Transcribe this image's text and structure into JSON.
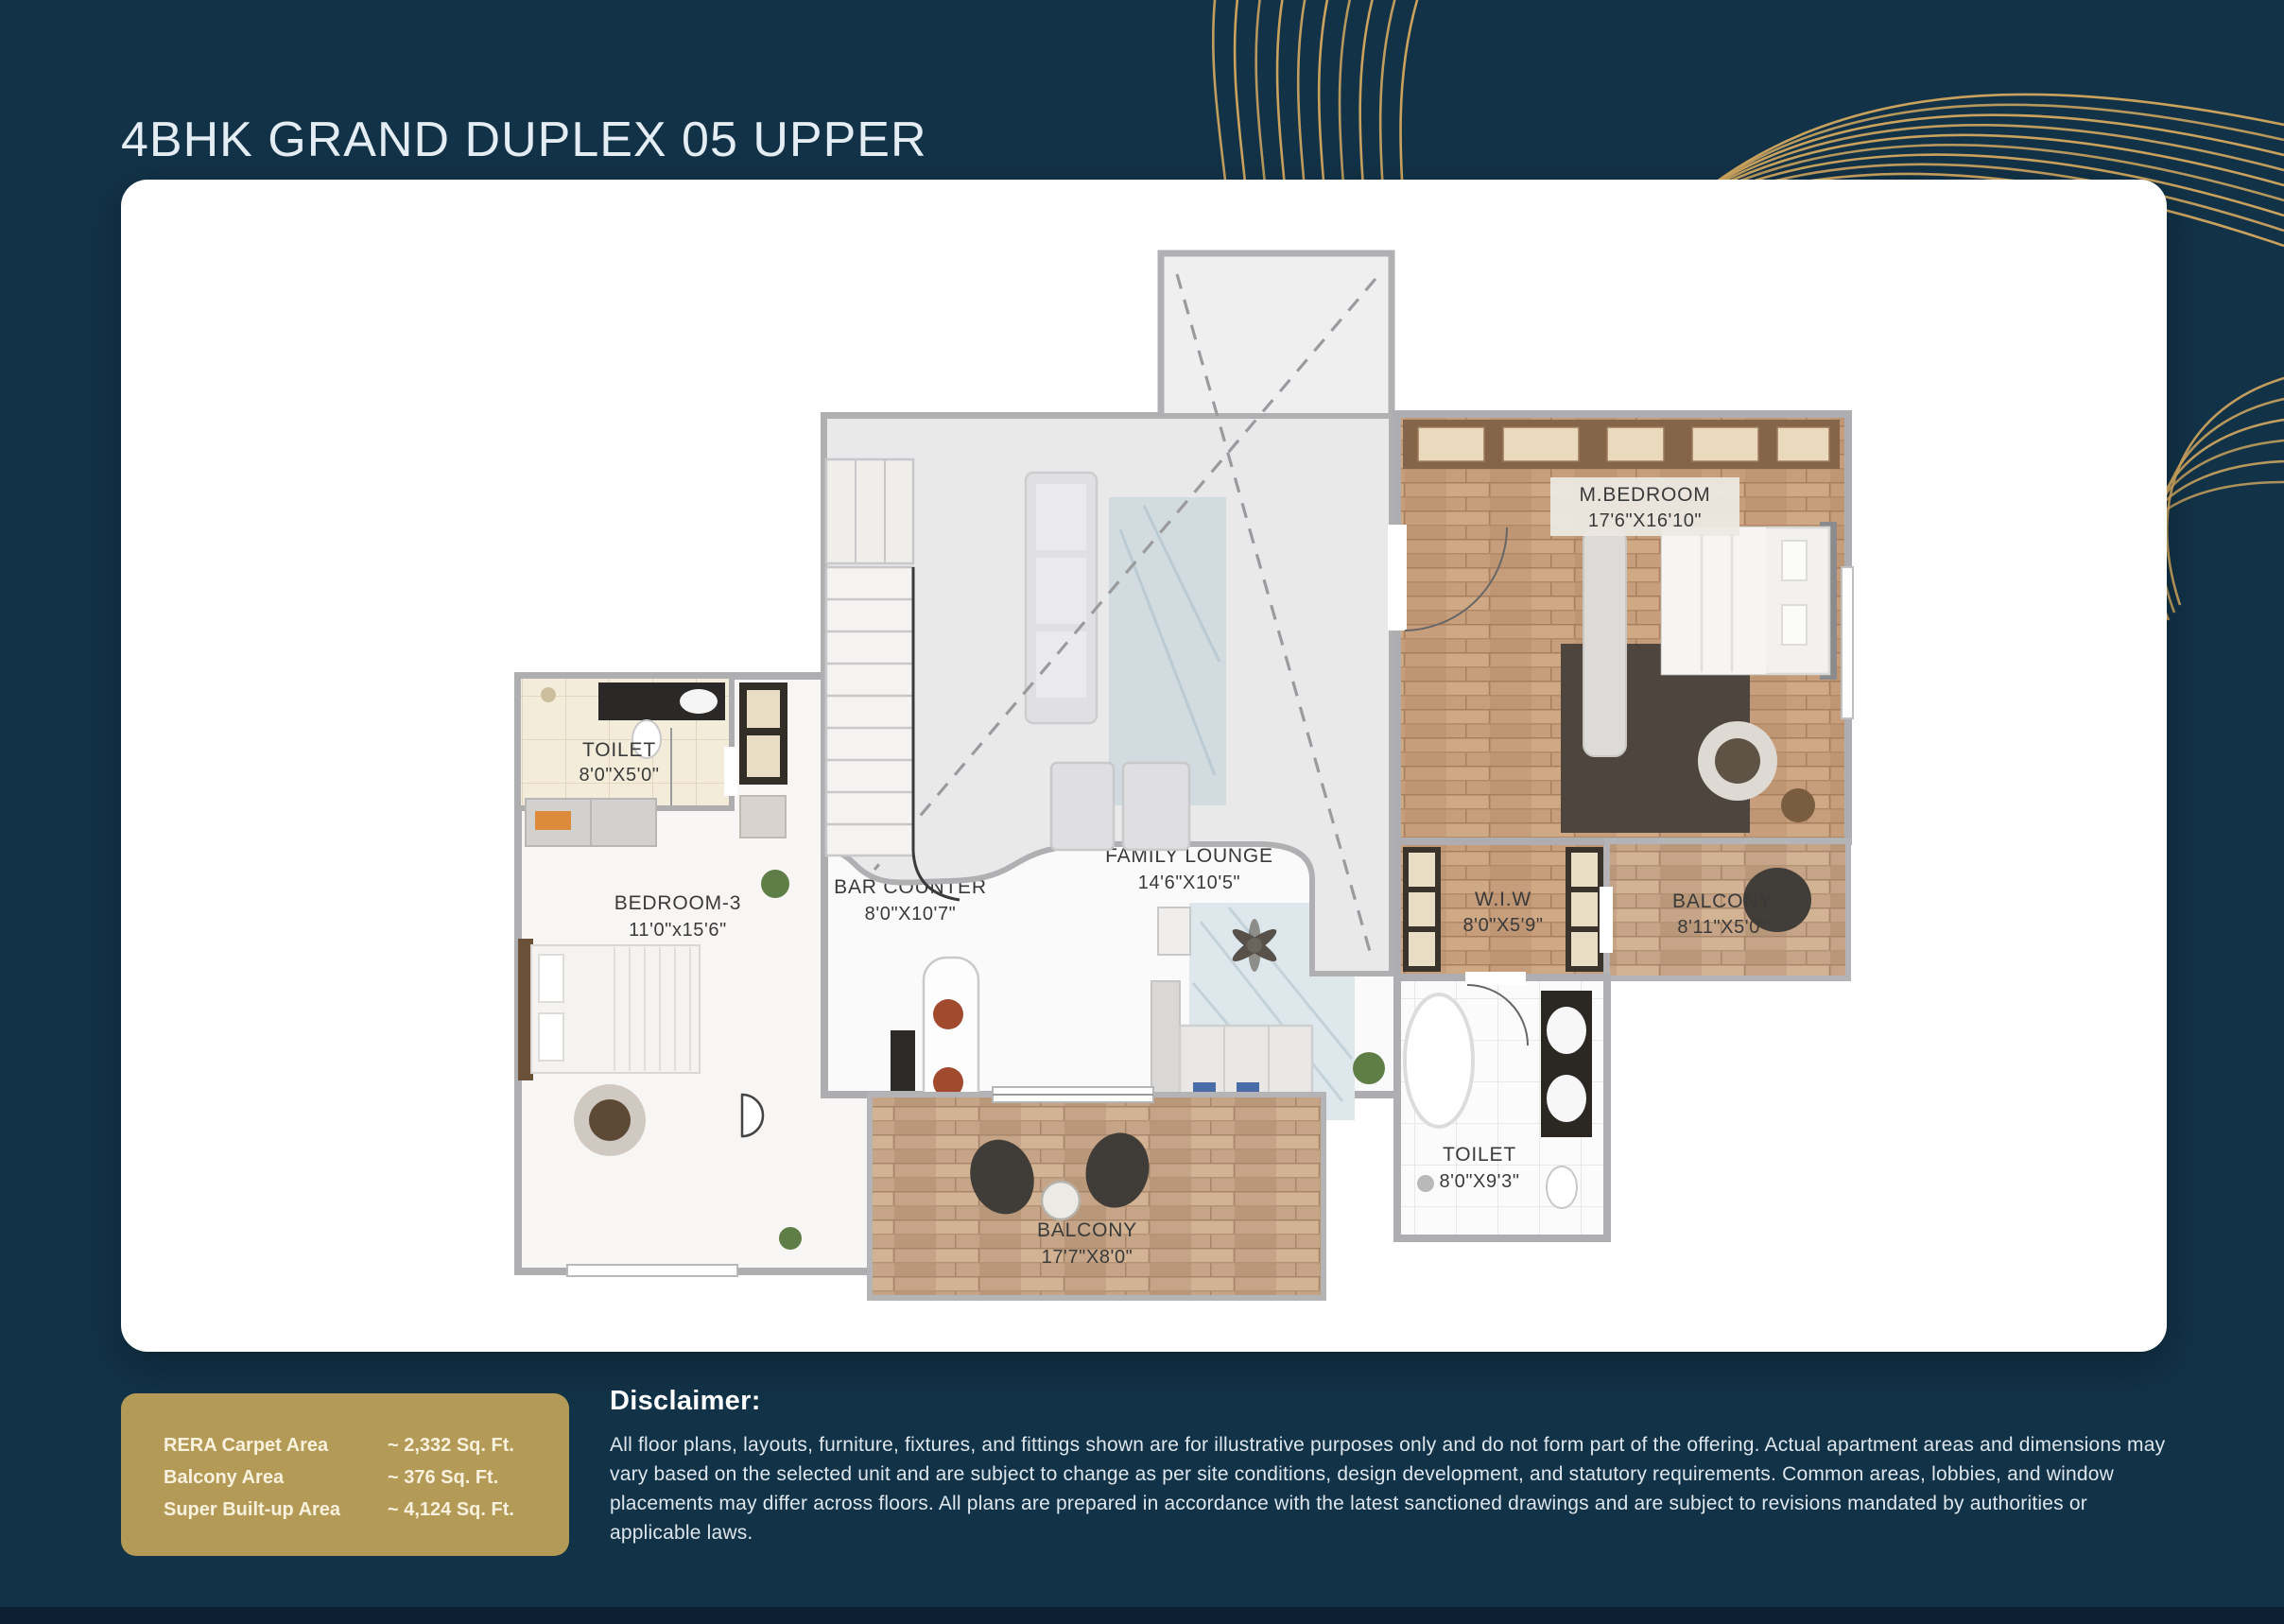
{
  "page": {
    "title": "4BHK GRAND DUPLEX 05 UPPER"
  },
  "colors": {
    "background_navy": "#123247",
    "swirl_gold": "#d4a960",
    "card_white": "#ffffff",
    "area_box_gold": "#b39a56",
    "label_dark": "#3a3a3a",
    "wood_floor": "#c79e7c"
  },
  "floor_plan": {
    "rooms": [
      {
        "name": "TOILET",
        "dims": "8'0\"X5'0\""
      },
      {
        "name": "BEDROOM-3",
        "dims": "11'0\"x15'6\""
      },
      {
        "name": "BAR COUNTER",
        "dims": "8'0\"X10'7\""
      },
      {
        "name": "FAMILY LOUNGE",
        "dims": "14'6\"X10'5\""
      },
      {
        "name": "M.BEDROOM",
        "dims": "17'6\"X16'10\""
      },
      {
        "name": "W.I.W",
        "dims": "8'0\"X5'9\""
      },
      {
        "name": "BALCONY",
        "dims": "8'11\"X5'0\""
      },
      {
        "name": "TOILET",
        "dims": "8'0\"X9'3\""
      },
      {
        "name": "BALCONY",
        "dims": "17'7\"X8'0\""
      }
    ]
  },
  "area_summary": {
    "rows": [
      {
        "label": "RERA Carpet Area",
        "value": "~ 2,332 Sq. Ft."
      },
      {
        "label": "Balcony Area",
        "value": "~ 376 Sq. Ft."
      },
      {
        "label": "Super Built-up Area",
        "value": "~ 4,124 Sq. Ft."
      }
    ]
  },
  "disclaimer": {
    "heading": "Disclaimer:",
    "body": "All floor plans, layouts, furniture, fixtures, and fittings shown are for illustrative purposes only and do not form part of the offering. Actual apartment areas and dimensions may vary based on the selected unit and are subject to change as per site conditions, design development, and statutory requirements. Common areas, lobbies, and window placements may differ across floors. All plans are prepared in accordance with the latest sanctioned drawings and are subject to revisions mandated by authorities or applicable laws."
  }
}
